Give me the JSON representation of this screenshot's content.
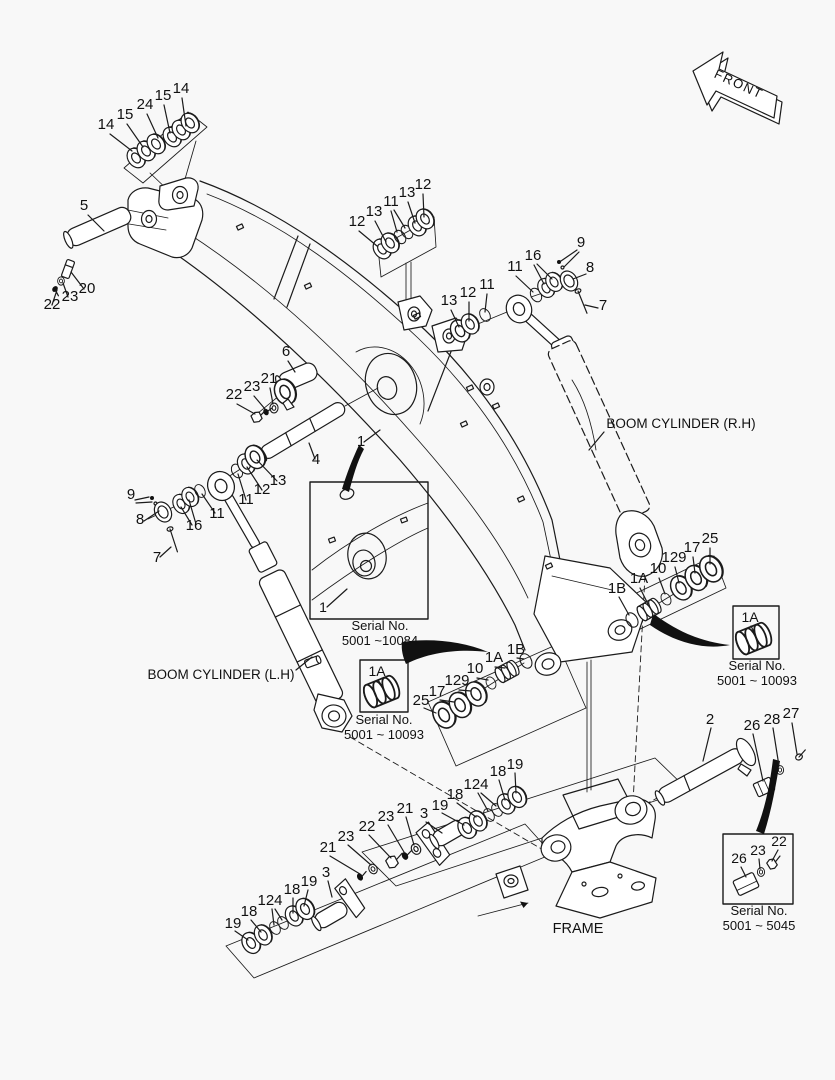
{
  "diagram": {
    "background_color": "#f8f8f8",
    "line_color": "#1b1b1b",
    "front_marker": {
      "text": "FRONT",
      "x": 737,
      "y": 88,
      "rotation": 25
    },
    "region_titles": [
      {
        "name": "boom-cylinder-rh-label",
        "text": "BOOM CYLINDER (R.H)",
        "x": 681,
        "y": 428,
        "fs": 13.5
      },
      {
        "name": "boom-cylinder-lh-label",
        "text": "BOOM CYLINDER (L.H)",
        "x": 221,
        "y": 679,
        "fs": 13.5
      },
      {
        "name": "frame-label",
        "text": "FRAME",
        "x": 578,
        "y": 933,
        "fs": 14.5
      }
    ],
    "serial_notes": [
      {
        "name": "serial-boom-detail",
        "lines": [
          "Serial No.",
          "5001 ~10084"
        ],
        "x": 380,
        "y": 630
      },
      {
        "name": "serial-bushing-center",
        "lines": [
          "Serial No.",
          "5001 ~ 10093"
        ],
        "x": 384,
        "y": 724
      },
      {
        "name": "serial-bushing-right",
        "lines": [
          "Serial No.",
          "5001 ~ 10093"
        ],
        "x": 757,
        "y": 670
      },
      {
        "name": "serial-frame-pin",
        "lines": [
          "Serial No.",
          "5001 ~ 5045"
        ],
        "x": 759,
        "y": 915
      }
    ],
    "callouts": [
      {
        "t": "14",
        "x": 106,
        "y": 129
      },
      {
        "t": "15",
        "x": 125,
        "y": 119
      },
      {
        "t": "24",
        "x": 145,
        "y": 109
      },
      {
        "t": "15",
        "x": 163,
        "y": 100
      },
      {
        "t": "14",
        "x": 181,
        "y": 93
      },
      {
        "t": "5",
        "x": 84,
        "y": 210
      },
      {
        "t": "20",
        "x": 87,
        "y": 293
      },
      {
        "t": "23",
        "x": 70,
        "y": 301
      },
      {
        "t": "22",
        "x": 52,
        "y": 309
      },
      {
        "t": "12",
        "x": 357,
        "y": 226
      },
      {
        "t": "13",
        "x": 374,
        "y": 216
      },
      {
        "t": "11",
        "x": 391,
        "y": 206
      },
      {
        "t": "13",
        "x": 407,
        "y": 197
      },
      {
        "t": "12",
        "x": 423,
        "y": 189
      },
      {
        "t": "13",
        "x": 449,
        "y": 305
      },
      {
        "t": "12",
        "x": 468,
        "y": 297
      },
      {
        "t": "11",
        "x": 487,
        "y": 289
      },
      {
        "t": "11",
        "x": 515,
        "y": 271
      },
      {
        "t": "16",
        "x": 533,
        "y": 260
      },
      {
        "t": "9",
        "x": 581,
        "y": 247
      },
      {
        "t": "8",
        "x": 590,
        "y": 272
      },
      {
        "t": "7",
        "x": 603,
        "y": 310
      },
      {
        "t": "6",
        "x": 286,
        "y": 356
      },
      {
        "t": "21",
        "x": 269,
        "y": 383
      },
      {
        "t": "23",
        "x": 252,
        "y": 391
      },
      {
        "t": "22",
        "x": 234,
        "y": 399
      },
      {
        "t": "4",
        "x": 316,
        "y": 464
      },
      {
        "t": "1",
        "x": 361,
        "y": 446
      },
      {
        "t": "9",
        "x": 131,
        "y": 499
      },
      {
        "t": "8",
        "x": 140,
        "y": 524
      },
      {
        "t": "7",
        "x": 157,
        "y": 562
      },
      {
        "t": "16",
        "x": 194,
        "y": 530
      },
      {
        "t": "11",
        "x": 217,
        "y": 518
      },
      {
        "t": "11",
        "x": 246,
        "y": 504
      },
      {
        "t": "12",
        "x": 262,
        "y": 494
      },
      {
        "t": "13",
        "x": 278,
        "y": 485
      },
      {
        "t": "1B",
        "x": 617,
        "y": 593
      },
      {
        "t": "1A",
        "x": 639,
        "y": 583
      },
      {
        "t": "10",
        "x": 658,
        "y": 573
      },
      {
        "t": "129",
        "x": 674,
        "y": 562
      },
      {
        "t": "17",
        "x": 692,
        "y": 552
      },
      {
        "t": "25",
        "x": 710,
        "y": 543
      },
      {
        "t": "25",
        "x": 421,
        "y": 705
      },
      {
        "t": "17",
        "x": 437,
        "y": 696
      },
      {
        "t": "129",
        "x": 457,
        "y": 685
      },
      {
        "t": "10",
        "x": 475,
        "y": 673
      },
      {
        "t": "1A",
        "x": 494,
        "y": 662
      },
      {
        "t": "1B",
        "x": 516,
        "y": 654
      },
      {
        "t": "1",
        "x": 323,
        "y": 612,
        "fs": 14
      },
      {
        "t": "1A",
        "x": 377,
        "y": 676,
        "fs": 14
      },
      {
        "t": "1A",
        "x": 750,
        "y": 622,
        "fs": 14
      },
      {
        "t": "2",
        "x": 710,
        "y": 724
      },
      {
        "t": "26",
        "x": 752,
        "y": 730
      },
      {
        "t": "28",
        "x": 772,
        "y": 724
      },
      {
        "t": "27",
        "x": 791,
        "y": 718
      },
      {
        "t": "26",
        "x": 739,
        "y": 863,
        "fs": 14
      },
      {
        "t": "23",
        "x": 758,
        "y": 855,
        "fs": 14
      },
      {
        "t": "22",
        "x": 779,
        "y": 846,
        "fs": 14
      },
      {
        "t": "19",
        "x": 440,
        "y": 810
      },
      {
        "t": "18",
        "x": 455,
        "y": 799
      },
      {
        "t": "124",
        "x": 476,
        "y": 789
      },
      {
        "t": "18",
        "x": 498,
        "y": 776
      },
      {
        "t": "19",
        "x": 515,
        "y": 769
      },
      {
        "t": "3",
        "x": 424,
        "y": 818
      },
      {
        "t": "21",
        "x": 405,
        "y": 813
      },
      {
        "t": "23",
        "x": 386,
        "y": 821
      },
      {
        "t": "22",
        "x": 367,
        "y": 831
      },
      {
        "t": "23",
        "x": 346,
        "y": 841
      },
      {
        "t": "21",
        "x": 328,
        "y": 852
      },
      {
        "t": "3",
        "x": 326,
        "y": 877
      },
      {
        "t": "19",
        "x": 233,
        "y": 928
      },
      {
        "t": "18",
        "x": 249,
        "y": 916
      },
      {
        "t": "124",
        "x": 270,
        "y": 905
      },
      {
        "t": "18",
        "x": 292,
        "y": 894
      },
      {
        "t": "19",
        "x": 309,
        "y": 886
      }
    ]
  }
}
